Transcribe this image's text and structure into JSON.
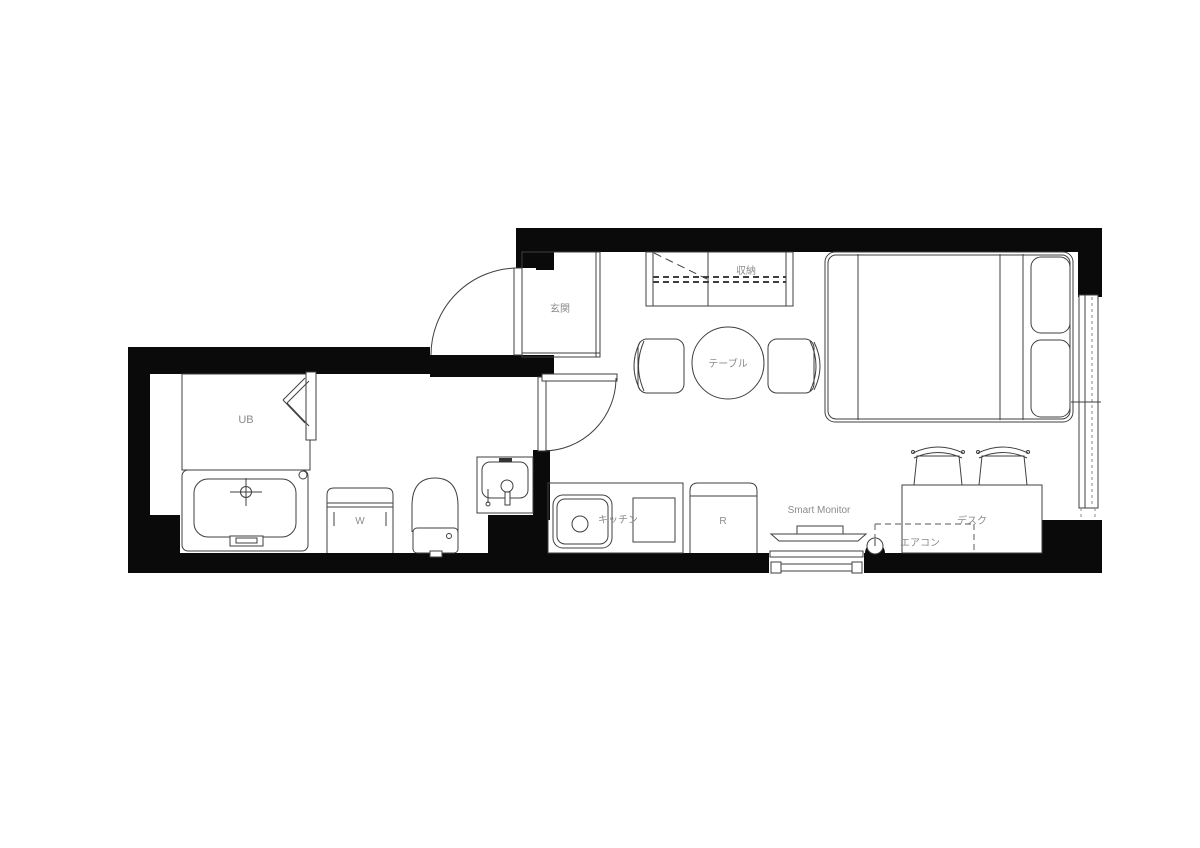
{
  "title": "studio-apartment-floor-plan",
  "colors": {
    "wall": "#0a0a0a",
    "line": "#3f3f3f",
    "label": "#8b8b8b",
    "dash": "#777777",
    "background": "#ffffff"
  },
  "labels": {
    "unit_bath": "UB",
    "washer": "W",
    "entrance": "玄関",
    "closet": "収納",
    "table": "テーブル",
    "kitchen": "キッチン",
    "fridge": "R",
    "smart_monitor": "Smart Monitor",
    "desk": "デスク",
    "aircon": "エアコン"
  }
}
